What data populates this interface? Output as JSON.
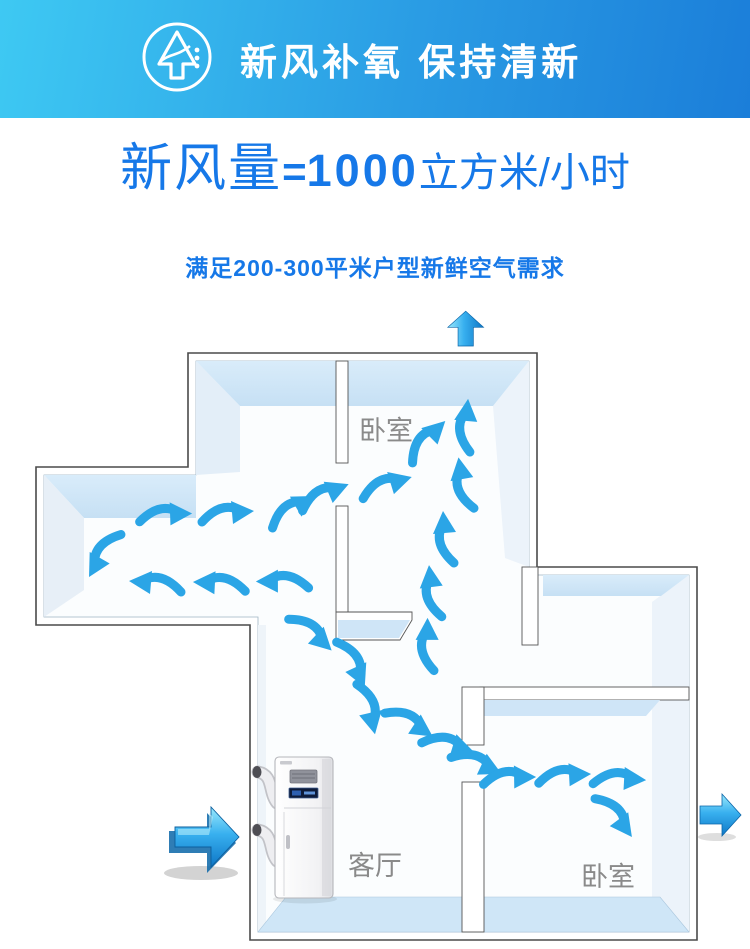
{
  "header": {
    "title": "新风补氧 保持清新",
    "icon": "tree-fresh-air-icon",
    "bg_left": "#3ec9f3",
    "bg_right": "#1b7ed9",
    "text_color": "#ffffff"
  },
  "headline": {
    "label": "新风量",
    "equals": "=",
    "value": "1000",
    "unit": "立方米/小时",
    "color": "#1678e8"
  },
  "subtitle": {
    "text": "满足200-300平米户型新鲜空气需求"
  },
  "floorplan": {
    "wall_face_color": "#cfe5f7",
    "wall_side_color": "#e8f0f8",
    "floor_band_color": "#cfe6f7",
    "outline_color": "#4a4a4a",
    "arrow_color": "#2ba5e6",
    "label_color": "#8a8a8a",
    "rooms": [
      {
        "id": "bedroom-top",
        "label": "卧室",
        "x": 386,
        "y": 140
      },
      {
        "id": "living-room",
        "label": "客厅",
        "x": 375,
        "y": 575
      },
      {
        "id": "bedroom-right",
        "label": "卧室",
        "x": 608,
        "y": 586
      }
    ],
    "device": {
      "id": "fresh-air-ventilation-unit"
    },
    "entry_exit_arrows": [
      {
        "id": "intake-arrow-left",
        "direction": "right"
      },
      {
        "id": "exhaust-arrow-top",
        "direction": "up"
      },
      {
        "id": "exhaust-arrow-right",
        "direction": "right"
      }
    ],
    "flow_arrows": [
      {
        "x": 425,
        "y": 142,
        "r": -40
      },
      {
        "x": 466,
        "y": 128,
        "r": -80
      },
      {
        "x": 464,
        "y": 186,
        "r": -95
      },
      {
        "x": 446,
        "y": 240,
        "r": -90
      },
      {
        "x": 433,
        "y": 294,
        "r": -92
      },
      {
        "x": 428,
        "y": 347,
        "r": -85
      },
      {
        "x": 322,
        "y": 196,
        "r": -18
      },
      {
        "x": 384,
        "y": 186,
        "r": -12
      },
      {
        "x": 163,
        "y": 215,
        "r": 3
      },
      {
        "x": 225,
        "y": 214,
        "r": 0
      },
      {
        "x": 290,
        "y": 211,
        "r": -25
      },
      {
        "x": 104,
        "y": 252,
        "r": 65,
        "flip": true
      },
      {
        "x": 158,
        "y": 284,
        "r": 0,
        "flip": true
      },
      {
        "x": 222,
        "y": 284,
        "r": 2,
        "flip": true
      },
      {
        "x": 285,
        "y": 282,
        "r": 5,
        "flip": true
      },
      {
        "x": 310,
        "y": 331,
        "r": 48
      },
      {
        "x": 352,
        "y": 361,
        "r": 70
      },
      {
        "x": 368,
        "y": 406,
        "r": 82
      },
      {
        "x": 408,
        "y": 421,
        "r": 38
      },
      {
        "x": 446,
        "y": 444,
        "r": 22
      },
      {
        "x": 475,
        "y": 462,
        "r": 30
      },
      {
        "x": 507,
        "y": 478,
        "r": 4
      },
      {
        "x": 562,
        "y": 476,
        "r": 2
      },
      {
        "x": 617,
        "y": 479,
        "r": 8
      },
      {
        "x": 614,
        "y": 514,
        "r": 58
      }
    ]
  }
}
